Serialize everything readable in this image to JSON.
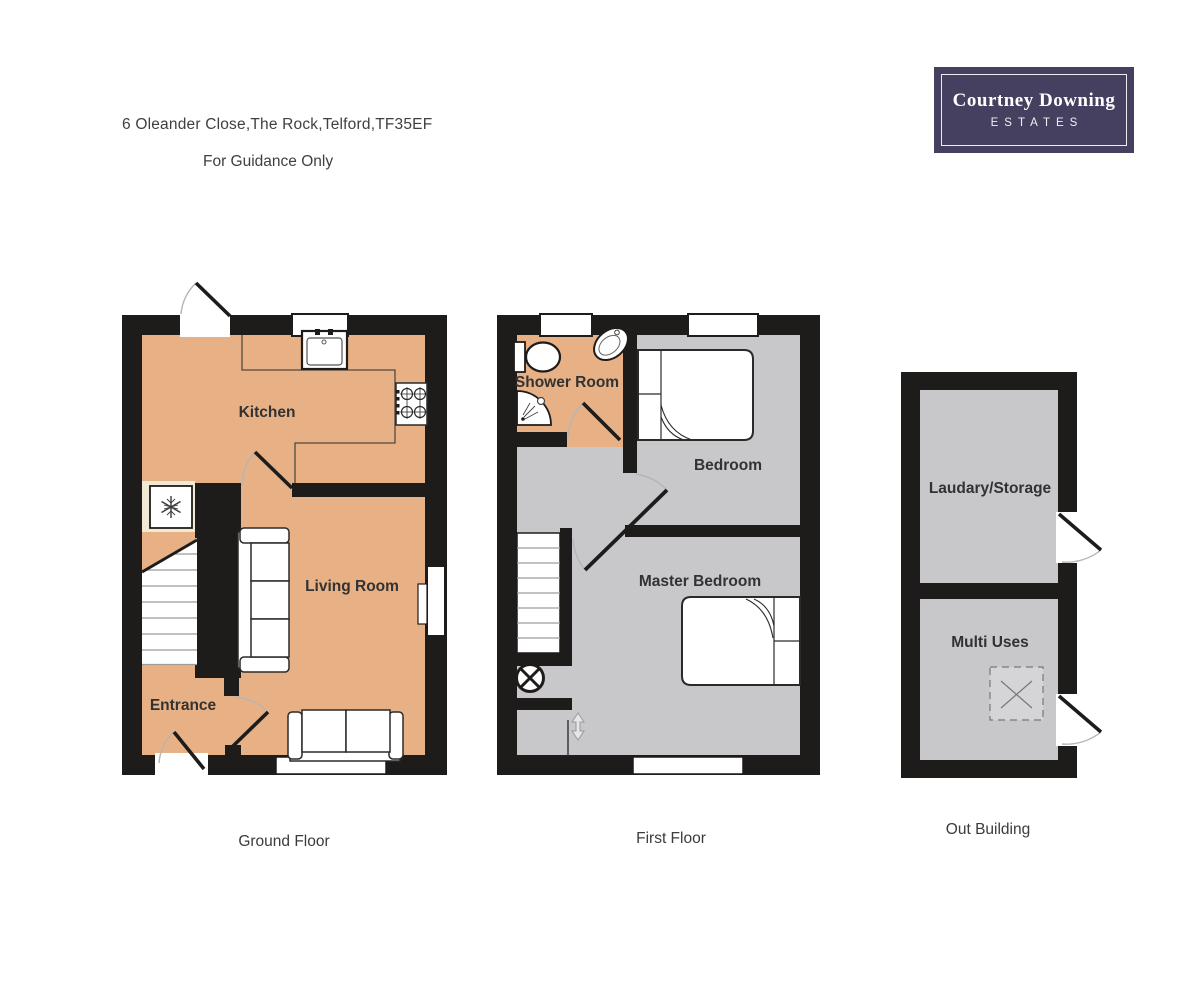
{
  "header": {
    "address": "6 Oleander Close,The Rock,Telford,TF35EF",
    "guidance": "For Guidance Only"
  },
  "logo": {
    "name": "Courtney Downing",
    "tagline": "ESTATES"
  },
  "plans": {
    "ground": {
      "caption": "Ground Floor",
      "rooms": {
        "kitchen": "Kitchen",
        "living_room": "Living Room",
        "entrance": "Entrance"
      }
    },
    "first": {
      "caption": "First Floor",
      "rooms": {
        "shower_room": "Shower Room",
        "bedroom": "Bedroom",
        "master_bedroom": "Master Bedroom"
      }
    },
    "out_building": {
      "caption": "Out Building",
      "rooms": {
        "laundry_storage": "Laudary/Storage",
        "multi_uses": "Multi Uses"
      }
    }
  },
  "icons": {
    "fridge": "snowflake-icon",
    "hob": "four-burner-hob-icon",
    "sink": "kitchen-sink-icon",
    "toilet": "toilet-icon",
    "basin": "basin-icon",
    "shower": "corner-shower-icon",
    "ceiling_light": "circle-cross-light-icon",
    "skylight": "square-cross-icon",
    "door_swing": "door-swing-arc"
  },
  "colors": {
    "wall": "#1E1B1B",
    "ground_floor_fill": "#E8B185",
    "upper_floor_fill": "#C8C8CB",
    "logo_background": "#453F60",
    "logo_text": "#FFFFFF",
    "room_label_text": "#323232"
  }
}
